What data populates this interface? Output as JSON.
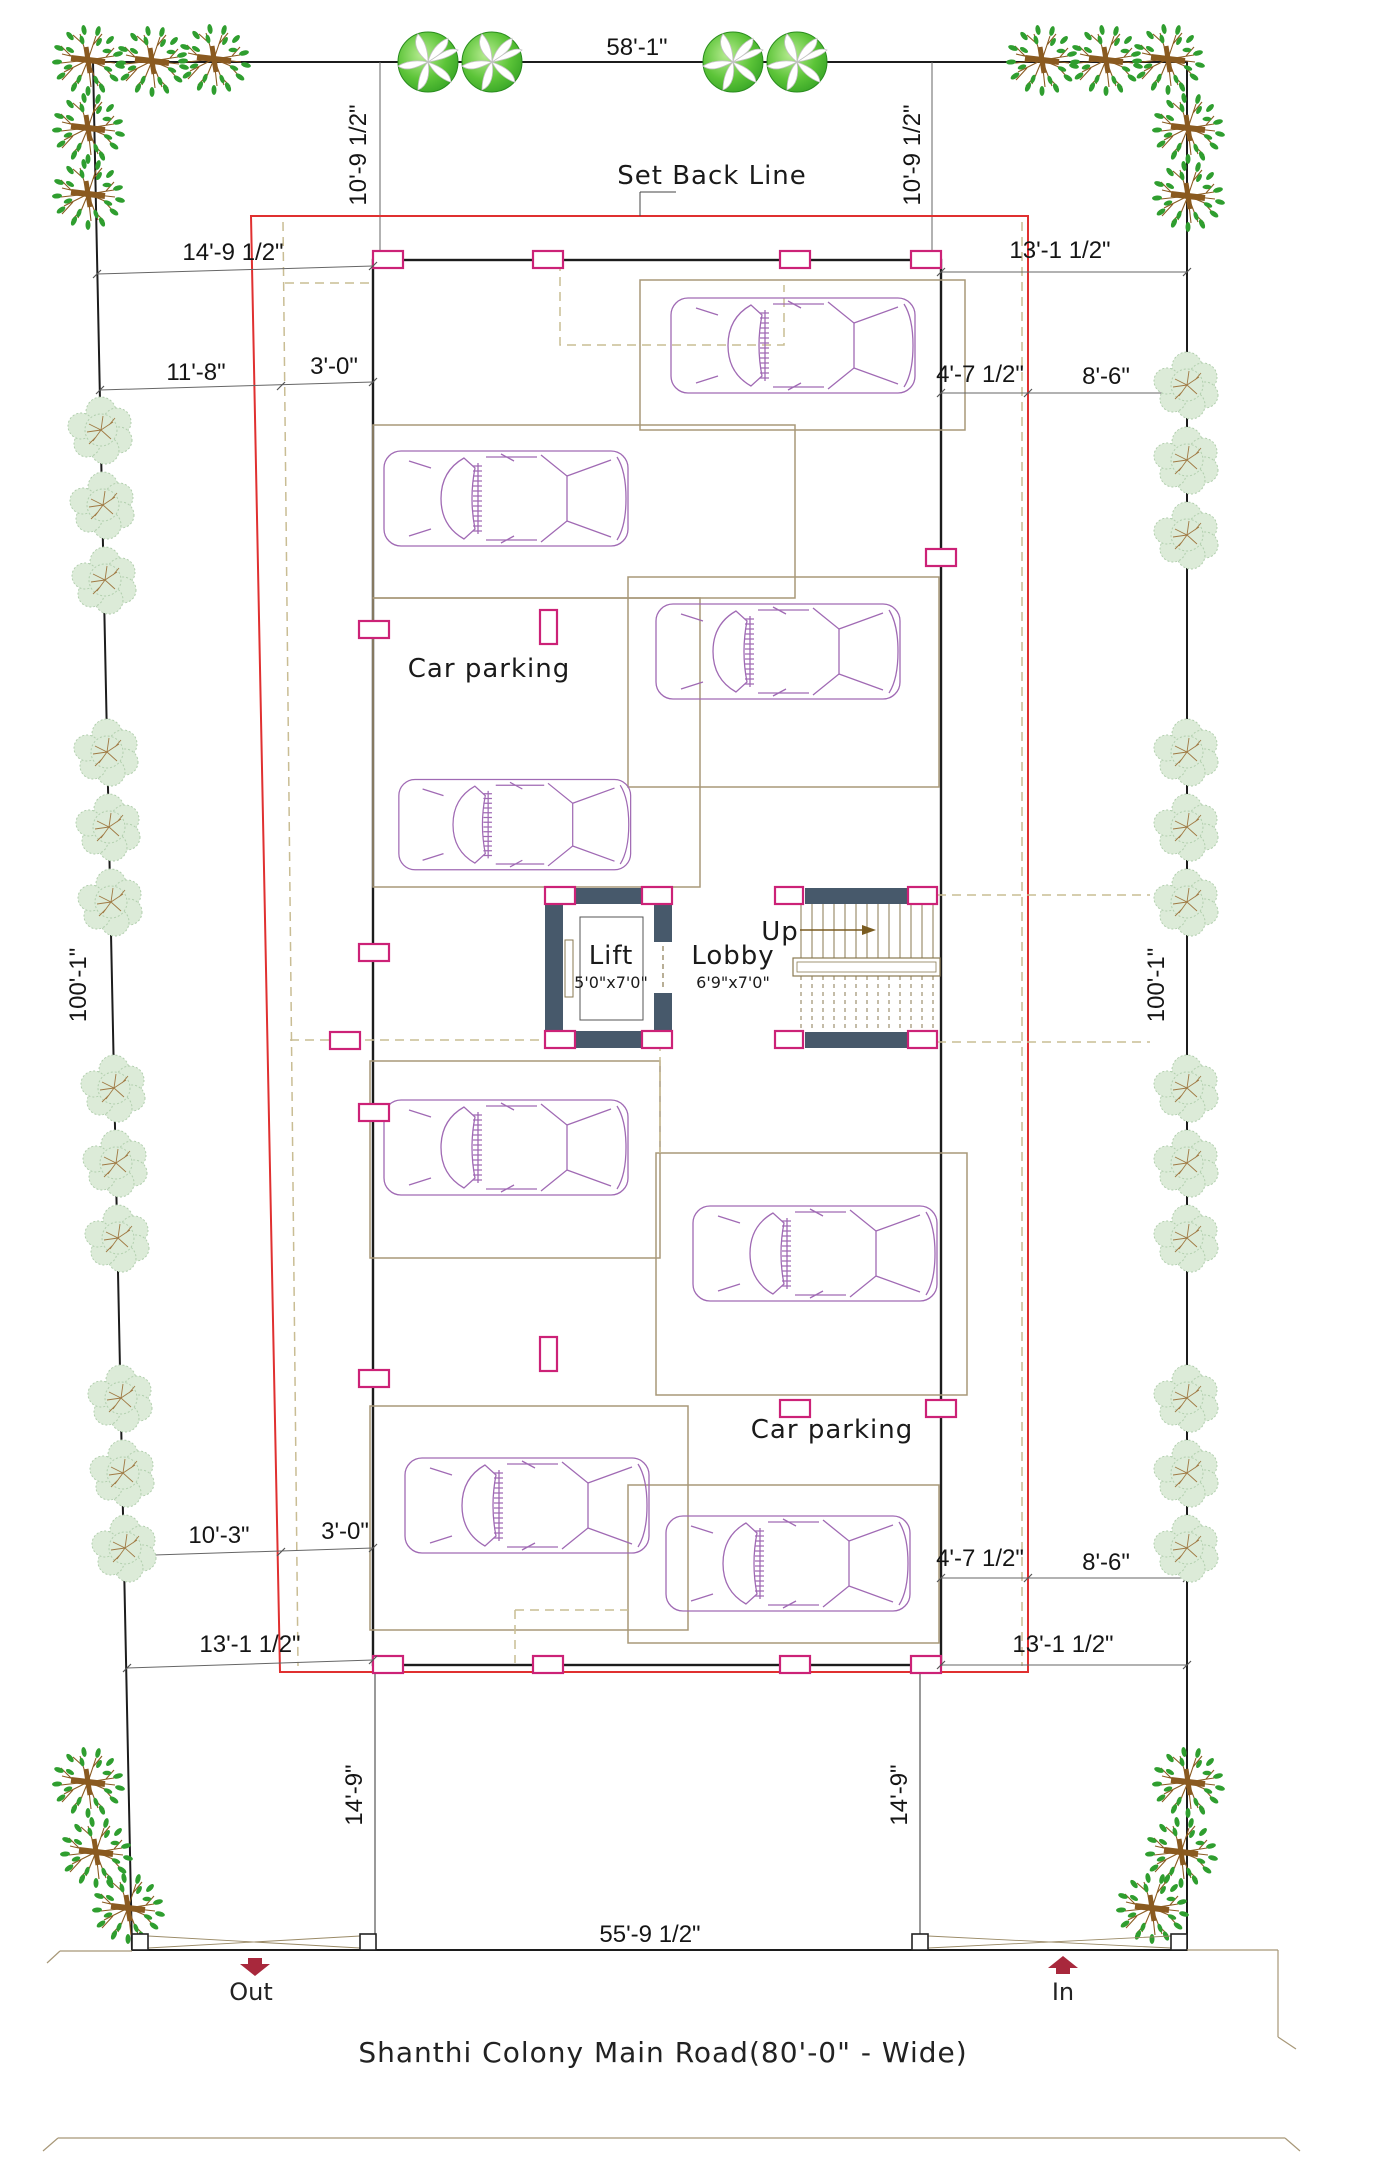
{
  "colors": {
    "setback_line": "#e03030",
    "column_marker": "#cc2277",
    "core_wall": "#47596b",
    "stall_line": "#a89878",
    "car_outline": "#a06ab4",
    "tree_green": "#3da028",
    "bush_green": "#dcebd8",
    "gate_arrow": "#a8283c",
    "boundary": "#1c1c1c"
  },
  "dims": {
    "top": "58'-1\"",
    "setback_left": "10'-9 1/2\"",
    "setback_right": "10'-9 1/2\"",
    "offset_top_left": "14'-9 1/2\"",
    "offset_top_right": "13'-1 1/2\"",
    "upper_left_a": "11'-8\"",
    "upper_left_b": "3'-0\"",
    "upper_right_a": "4'-7 1/2\"",
    "upper_right_b": "8'-6\"",
    "height_left": "100'-1\"",
    "height_right": "100'-1\"",
    "lower_left_a": "10'-3\"",
    "lower_left_b": "3'-0\"",
    "lower_right_a": "4'-7 1/2\"",
    "lower_right_b": "8'-6\"",
    "offset_bottom_left": "13'-1 1/2\"",
    "offset_bottom_right": "13'-1 1/2\"",
    "wall_left": "14'-9\"",
    "wall_right": "14'-9\"",
    "bottom": "55'-9 1/2\""
  },
  "labels": {
    "setback": "Set Back Line",
    "parking_upper": "Car parking",
    "parking_lower": "Car parking",
    "lift": "Lift",
    "lift_size": "5'0\"x7'0\"",
    "lobby": "Lobby",
    "lobby_size": "6'9\"x7'0\"",
    "up": "Up",
    "out": "Out",
    "in": "In",
    "road": "Shanthi Colony Main Road(80'-0\" - Wide)"
  }
}
